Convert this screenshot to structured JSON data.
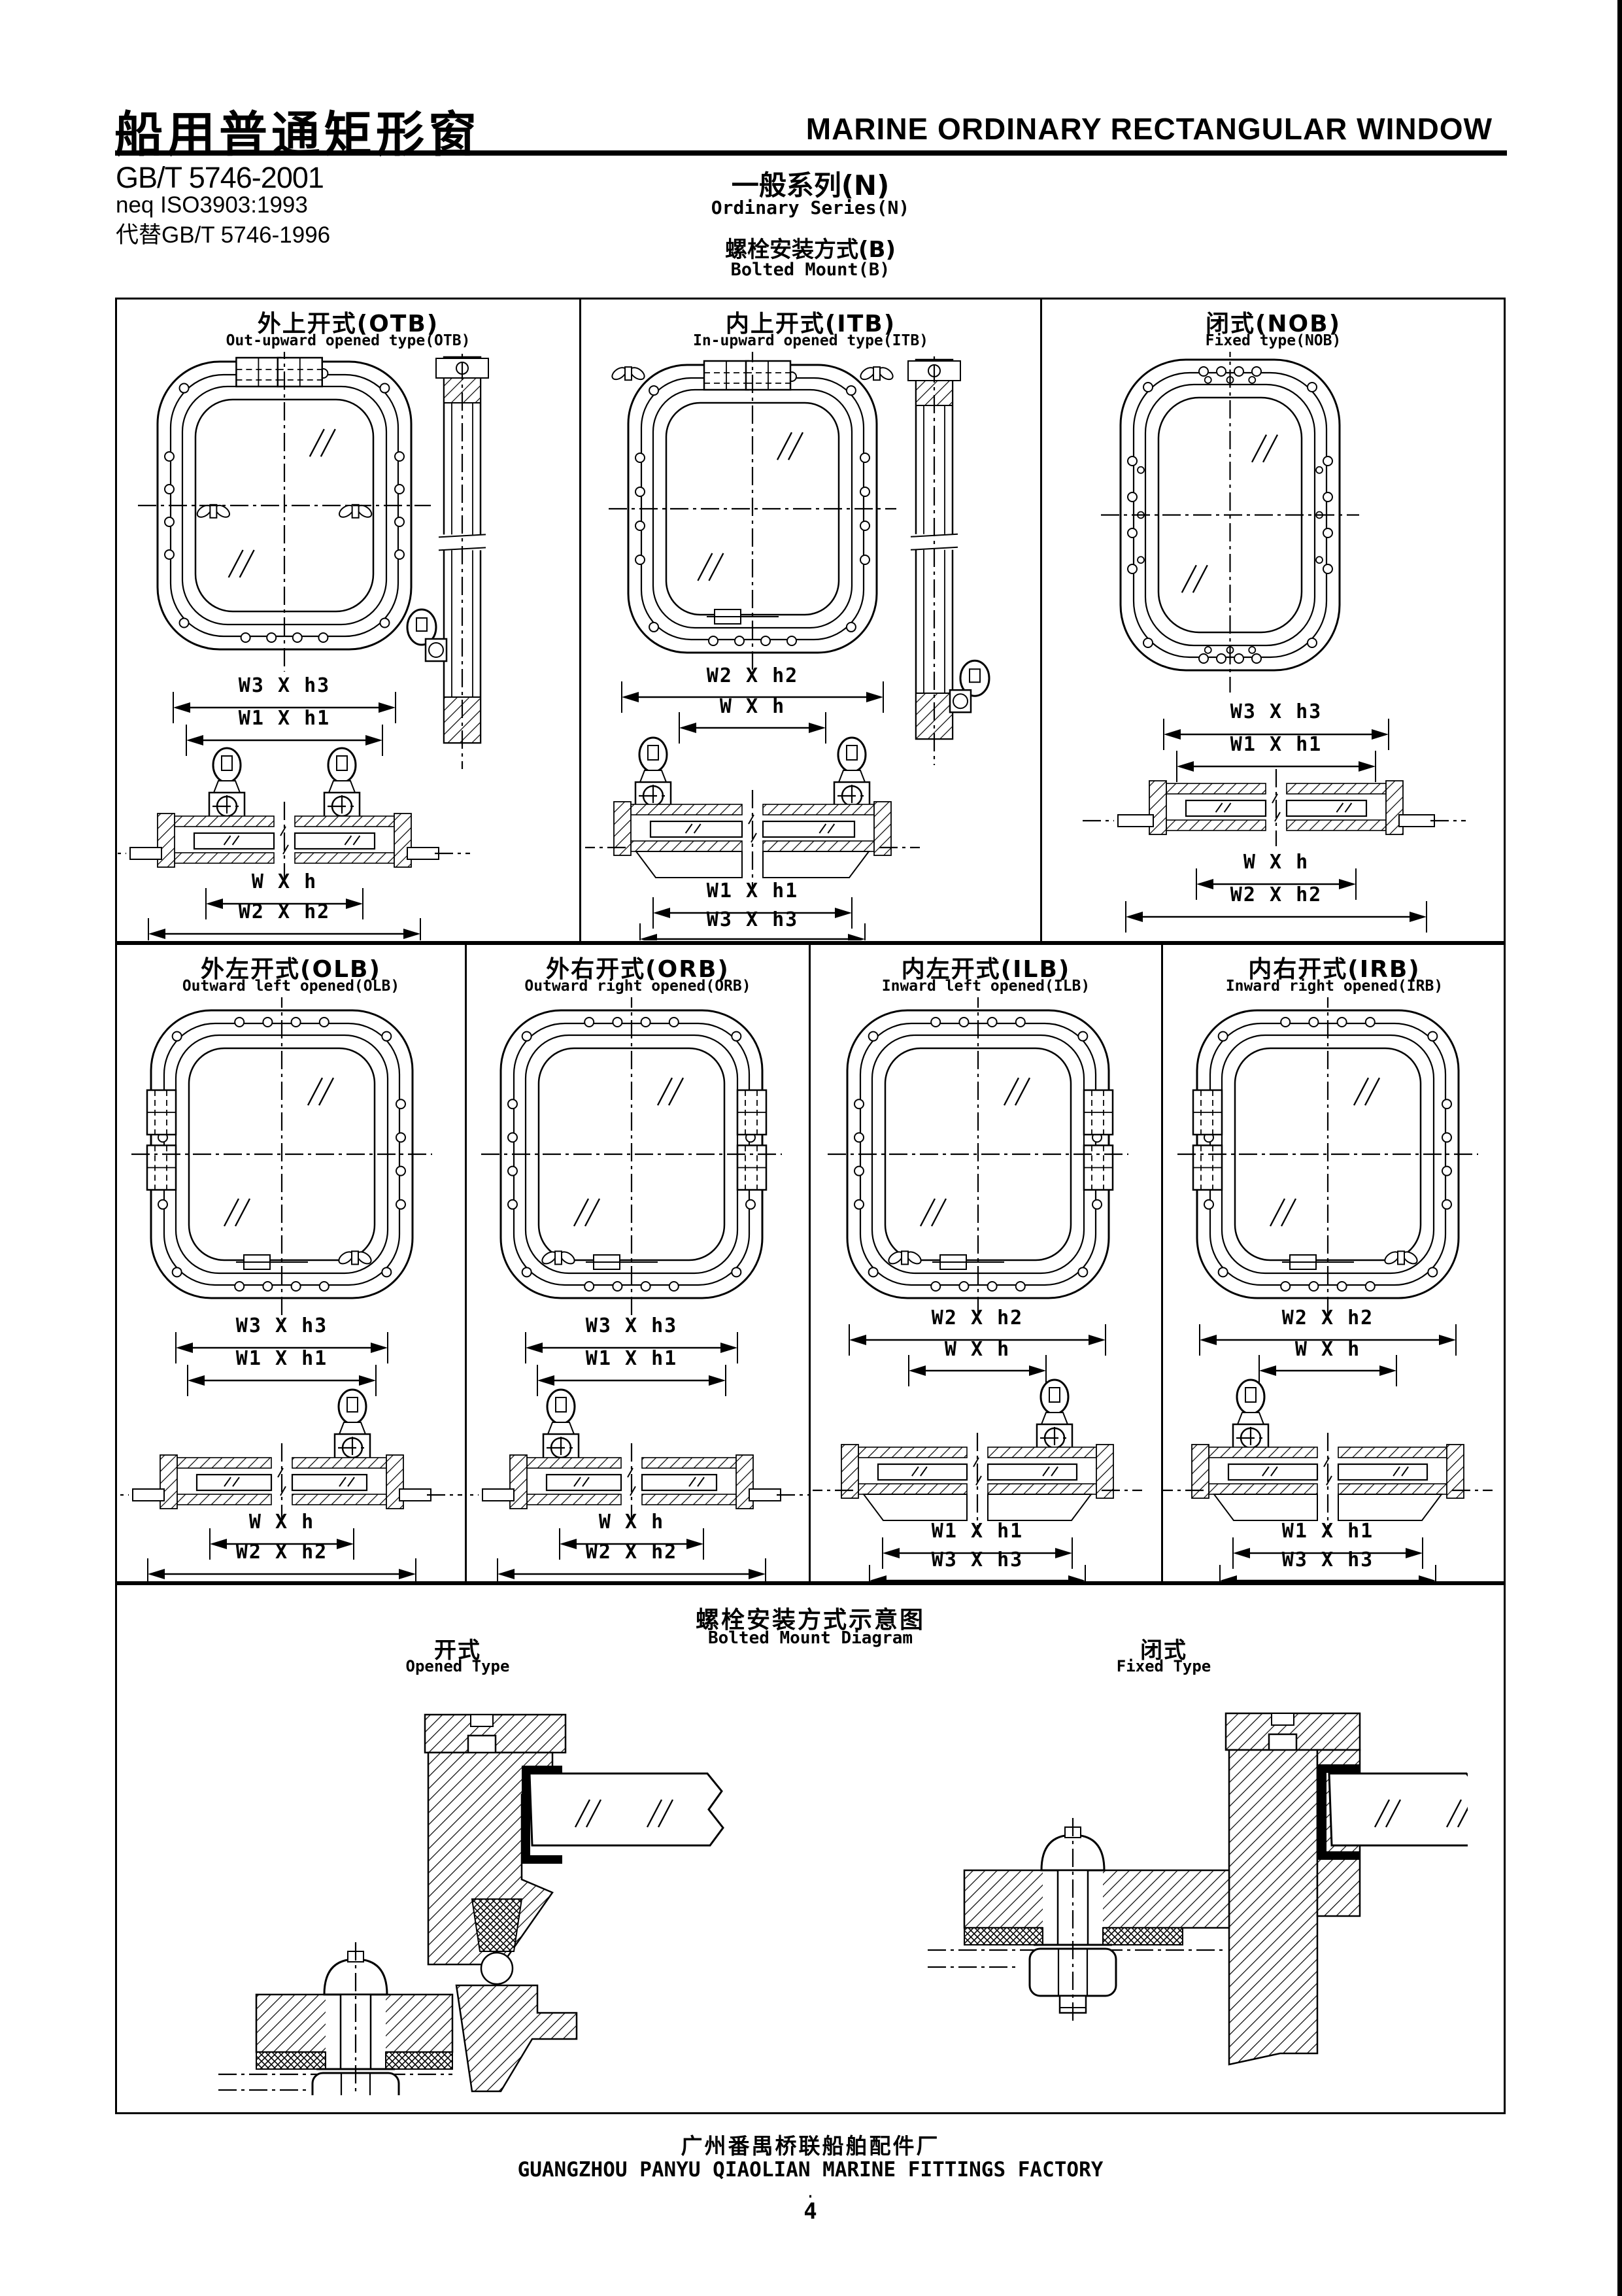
{
  "header": {
    "title_cn": "船用普通矩形窗",
    "title_en": "MARINE ORDINARY RECTANGULAR WINDOW",
    "standard1": "GB/T 5746-2001",
    "standard2": "neq ISO3903:1993",
    "standard3": "代替GB/T 5746-1996",
    "series_cn": "一般系列(N)",
    "series_en": "Ordinary Series(N)",
    "mount_cn": "螺栓安装方式(B)",
    "mount_en": "Bolted Mount(B)"
  },
  "cells": [
    {
      "id": "otb",
      "title_cn": "外上开式(OTB)",
      "title_en": "Out-upward opened type(OTB)",
      "dims_above": [
        "W3 X h3",
        "W1 X h1"
      ],
      "dims_below": [
        "W X h",
        "W2 X h2"
      ]
    },
    {
      "id": "itb",
      "title_cn": "内上开式(ITB)",
      "title_en": "In-upward opened type(ITB)",
      "dims_above": [
        "W2 X h2",
        "W X h"
      ],
      "dims_below": [
        "W1 X h1",
        "W3 X h3"
      ]
    },
    {
      "id": "nob",
      "title_cn": "闭式(NOB)",
      "title_en": "Fixed type(NOB)",
      "dims_above": [
        "W3 X h3",
        "W1 X h1"
      ],
      "dims_below": [
        "W X h",
        "W2 X h2"
      ]
    },
    {
      "id": "olb",
      "title_cn": "外左开式(OLB)",
      "title_en": "Outward left opened(OLB)",
      "dims_above": [
        "W3 X h3",
        "W1 X h1"
      ],
      "dims_below": [
        "W X h",
        "W2 X h2"
      ]
    },
    {
      "id": "orb",
      "title_cn": "外右开式(ORB)",
      "title_en": "Outward right opened(ORB)",
      "dims_above": [
        "W3 X h3",
        "W1 X h1"
      ],
      "dims_below": [
        "W X h",
        "W2 X h2"
      ]
    },
    {
      "id": "ilb",
      "title_cn": "内左开式(ILB)",
      "title_en": "Inward left opened(ILB)",
      "dims_above": [
        "W2 X h2",
        "W X h"
      ],
      "dims_below": [
        "W1 X h1",
        "W3 X h3"
      ]
    },
    {
      "id": "irb",
      "title_cn": "内右开式(IRB)",
      "title_en": "Inward right opened(IRB)",
      "dims_above": [
        "W2 X h2",
        "W X h"
      ],
      "dims_below": [
        "W1 X h1",
        "W3 X h3"
      ]
    }
  ],
  "bottom": {
    "title_cn": "螺栓安装方式示意图",
    "title_en": "Bolted Mount Diagram",
    "left_cn": "开式",
    "left_en": "Opened Type",
    "right_cn": "闭式",
    "right_en": "Fixed Type"
  },
  "footer": {
    "factory_cn": "广州番禺桥联船舶配件厂",
    "factory_en": "GUANGZHOU PANYU QIAOLIAN MARINE FITTINGS FACTORY",
    "dot": "·",
    "page": "4"
  }
}
